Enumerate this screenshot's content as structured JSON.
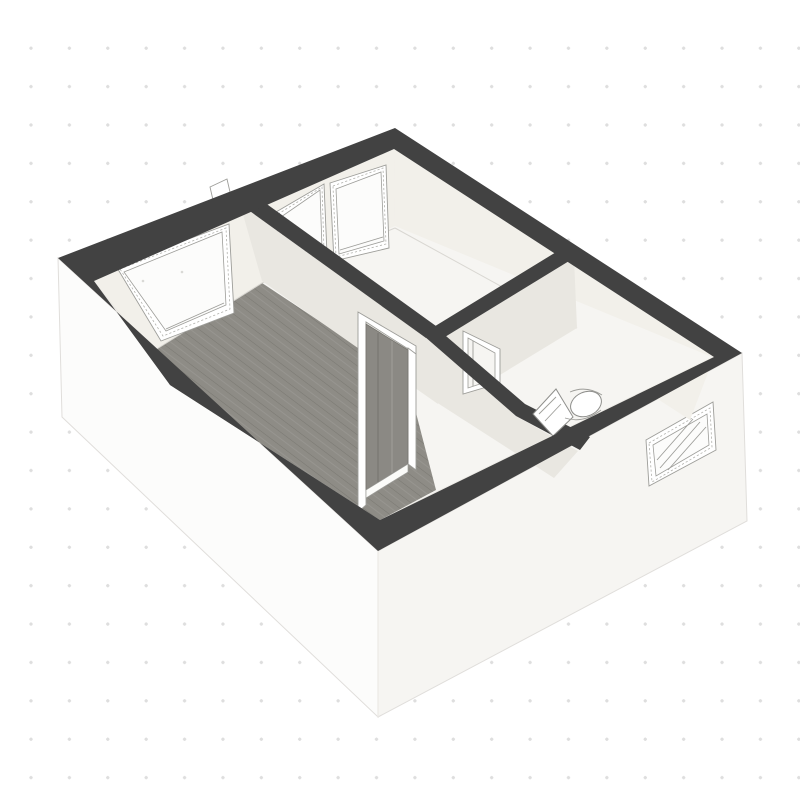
{
  "app": {
    "name": "3D floor plan view",
    "view_mode": "3D overview"
  },
  "scene": {
    "type": "isometric-3d-floor-plan",
    "rooms": [
      {
        "name": "living-room",
        "floor": "wood-planks",
        "windows": 1
      },
      {
        "name": "middle-room",
        "floor": "light",
        "windows": 2
      },
      {
        "name": "hallway",
        "floor": "light",
        "windows": 0
      },
      {
        "name": "bathroom",
        "floor": "light",
        "fixtures": [
          "toilet"
        ]
      }
    ],
    "features": {
      "exterior_windows": 1,
      "interior_doorways": 2,
      "open_door_leaf": true,
      "wall_top_style": "dark-cut-caps",
      "background": "white-dot-grid"
    }
  },
  "colors": {
    "background": "#ffffff",
    "grid_dot": "#dedede",
    "wall_cap": "#424242",
    "exterior_wall_left": "#fcfcfb",
    "exterior_wall_right": "#f6f5f2",
    "interior_wall": "#eceae5",
    "interior_wall_light": "#f2f0ea",
    "interior_wall_shaded": "#e9e7e1",
    "wood_floor": "#8e8c86",
    "light_floor": "#f6f5f2",
    "glass": "#fcfcfb",
    "sketch_line": "#9d9d99",
    "door_leaf": "#8b8984",
    "edge_line": "#e0dedb"
  }
}
